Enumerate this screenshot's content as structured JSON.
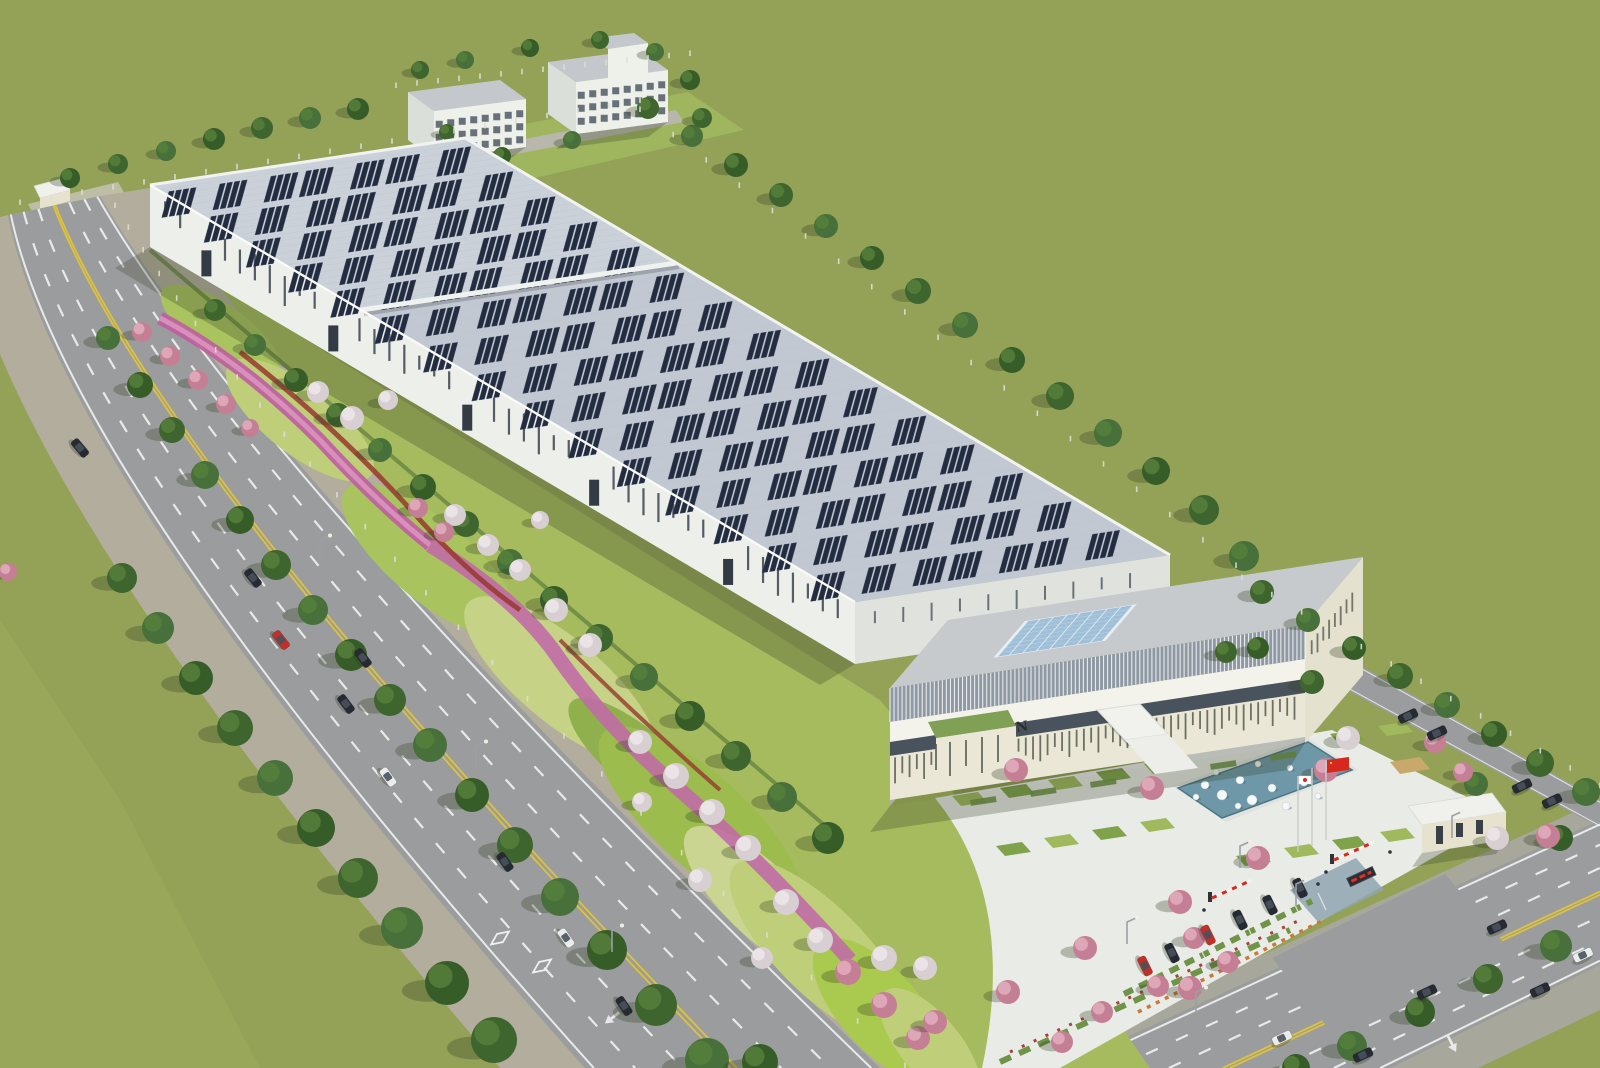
{
  "scene": {
    "sign": "CITIZEN",
    "flags": [
      {
        "name": "china-flag",
        "color": "#D7281E",
        "star": "#F8D33A"
      },
      {
        "name": "japan-flag",
        "color": "#FFFFFF",
        "dot": "#D7281E"
      }
    ],
    "colors": {
      "field": "#93A257",
      "fieldLight": "#9EAC5F",
      "road": "#9B9C9E",
      "sidewalk": "#B3AD9D",
      "sidewalk2": "#A8A79B",
      "laneYellow": "#E4C52F",
      "laneWhite": "#EFF1F1",
      "beltBase": "#A6BA5E",
      "beltL1": "#BFCE79",
      "beltL2": "#9CBC4D",
      "beltL3": "#C6D286",
      "beltL4": "#8FB04C",
      "ribbonMagenta": "#BE5E9E",
      "ribbonPink": "#D98FBC",
      "ribbonRed": "#96382E",
      "hedgeDark": "#5E7F3C",
      "treeGreen": "#3F652F",
      "treeGreen2": "#47703A",
      "treeGreen3": "#365C28",
      "treeLight": "#567F3B",
      "blossomWhite": "#D8CFD3",
      "blossomWhiteHi": "#EDE7E9",
      "blossomPink": "#C57F95",
      "blossomPinkHi": "#E0AEBE",
      "roofA": "#CBD1D9",
      "roofB": "#C2C8D2",
      "corr": "#B7BECA",
      "panel": "#242C40",
      "panelEdge": "#3A4560",
      "wall": "#EDEFEA",
      "wallShade": "#E0E3DD",
      "slit": "#39424C",
      "door": "#333B44",
      "parapet": "#F2F3F1",
      "officeRoof": "#C6CACD",
      "skylight": "#9FC0D8",
      "skyGrid": "#DCE8EE",
      "louverBg": "#8F99A3",
      "louverLine": "#FFFFFF",
      "bandWhite": "#F3F3EC",
      "glassBand": "#49535D",
      "cream": "#EAE7D6",
      "creamShade": "#DDD9C6",
      "creamDark": "#E4E1CF",
      "offSlit": "#565B4E",
      "signText": "#2A2E33",
      "wingGreen": "#7FA055",
      "pavement": "#E9EBE7",
      "grassSq": "#9FB95C",
      "grassSqDark": "#7FA24A",
      "tanSq": "#C8A96B",
      "pondRim": "#DFE3DE",
      "pond": "#6E98A8",
      "pondEdge": "#4E7585",
      "sphere": "#F4F8F8",
      "hedge": "#6F9347",
      "stallOrange": "#C8793C",
      "gatehouseRoof": "#F0F1ED",
      "gatehouseWall": "#E6E2CE",
      "ledBg": "#2A2D33",
      "ledRed": "#E03020",
      "apronBlue": "#8FA6B2",
      "concretePad": "#C6C3B4",
      "flagRed": "#D7281E",
      "flagDotYellow": "#F8D33A",
      "carBlack": "#262B33",
      "carRed": "#C23027",
      "carWhite": "#E9EDEC",
      "carGlass": "#49525C",
      "post": "#DEDED8",
      "lampPole": "#9AA0A6",
      "shadow": "rgba(50,62,32,0.30)",
      "bldgShadow": "rgba(55,65,40,0.28)",
      "dormRoof": "#C4C8CD",
      "dormWall": "#EEF0EA",
      "dormSide": "#DBDFDA",
      "dormWin": "#46515C",
      "dormPad": "#9FB55E",
      "dormPath": "#B9B7AC"
    },
    "roads": {
      "left": {
        "a": [
          8,
          215,
          60,
          480,
          585,
          1068
        ],
        "b": [
          100,
          196,
          260,
          470,
          880,
          1068
        ]
      },
      "bottom": {
        "a": [
          1060,
          1068,
          1600,
          820
        ],
        "b": [
          1390,
          1068,
          1600,
          965
        ]
      },
      "service": {
        "a": [
          1240,
          598,
          1600,
          800
        ],
        "b": [
          1226,
          624,
          1600,
          828
        ]
      }
    },
    "panels": {
      "hallA": {
        "matrix": [
          3.15,
          -0.47,
          2.11,
          1.25,
          150,
          185
        ],
        "cols": 7,
        "rows": 5,
        "s0": 4,
        "t0": 6,
        "ds": 14.2,
        "dt": 20
      },
      "hallB": {
        "matrix": [
          3.15,
          -0.47,
          4.94,
          2.92,
          361,
          310
        ],
        "cols": 7,
        "rows": 10,
        "s0": 4,
        "t0": 3,
        "ds": 14.2,
        "dt": 9.8
      }
    },
    "trees_back": [
      [
        648,
        108,
        11
      ],
      [
        692,
        136,
        11
      ],
      [
        736,
        165,
        12
      ],
      [
        781,
        195,
        12
      ],
      [
        826,
        226,
        12
      ],
      [
        872,
        258,
        12
      ],
      [
        918,
        291,
        13
      ],
      [
        965,
        325,
        13
      ],
      [
        1012,
        360,
        13
      ],
      [
        1060,
        396,
        14
      ],
      [
        1108,
        433,
        14
      ],
      [
        1156,
        471,
        14
      ],
      [
        1204,
        510,
        15
      ],
      [
        1244,
        556,
        15
      ],
      [
        70,
        178,
        10
      ],
      [
        118,
        164,
        10
      ],
      [
        166,
        151,
        10
      ],
      [
        214,
        139,
        11
      ],
      [
        262,
        128,
        11
      ],
      [
        310,
        118,
        11
      ],
      [
        358,
        109,
        11
      ],
      [
        420,
        70,
        9
      ],
      [
        465,
        60,
        9
      ],
      [
        530,
        48,
        9
      ],
      [
        600,
        40,
        9
      ],
      [
        655,
        52,
        9
      ],
      [
        690,
        80,
        10
      ],
      [
        702,
        118,
        10
      ],
      [
        572,
        140,
        9
      ],
      [
        502,
        156,
        9
      ],
      [
        447,
        132,
        8
      ]
    ],
    "trees": {
      "green": [
        [
          122,
          578,
          15
        ],
        [
          158,
          628,
          16
        ],
        [
          196,
          678,
          17
        ],
        [
          235,
          728,
          18
        ],
        [
          275,
          778,
          18
        ],
        [
          316,
          828,
          19
        ],
        [
          358,
          878,
          20
        ],
        [
          402,
          928,
          21
        ],
        [
          447,
          983,
          22
        ],
        [
          494,
          1040,
          23
        ],
        [
          108,
          338,
          12
        ],
        [
          140,
          385,
          13
        ],
        [
          172,
          430,
          13
        ],
        [
          205,
          475,
          14
        ],
        [
          240,
          520,
          14
        ],
        [
          276,
          565,
          15
        ],
        [
          313,
          610,
          15
        ],
        [
          351,
          655,
          16
        ],
        [
          390,
          700,
          16
        ],
        [
          430,
          745,
          17
        ],
        [
          472,
          795,
          17
        ],
        [
          515,
          845,
          18
        ],
        [
          560,
          897,
          19
        ],
        [
          607,
          950,
          20
        ],
        [
          656,
          1005,
          21
        ],
        [
          707,
          1060,
          22
        ],
        [
          760,
          1062,
          18
        ],
        [
          215,
          310,
          11
        ],
        [
          255,
          345,
          11
        ],
        [
          296,
          380,
          12
        ],
        [
          338,
          415,
          12
        ],
        [
          380,
          450,
          12
        ],
        [
          423,
          487,
          13
        ],
        [
          466,
          524,
          13
        ],
        [
          510,
          562,
          13
        ],
        [
          554,
          600,
          14
        ],
        [
          599,
          638,
          14
        ],
        [
          644,
          677,
          14
        ],
        [
          690,
          716,
          15
        ],
        [
          736,
          756,
          15
        ],
        [
          782,
          797,
          15
        ],
        [
          828,
          838,
          16
        ],
        [
          1262,
          592,
          12
        ],
        [
          1308,
          620,
          12
        ],
        [
          1354,
          648,
          12
        ],
        [
          1400,
          676,
          13
        ],
        [
          1447,
          705,
          13
        ],
        [
          1494,
          734,
          13
        ],
        [
          1540,
          763,
          14
        ],
        [
          1586,
          792,
          14
        ],
        [
          1258,
          648,
          11
        ],
        [
          1312,
          682,
          12
        ],
        [
          1476,
          784,
          12
        ],
        [
          1560,
          838,
          13
        ],
        [
          1226,
          652,
          11
        ],
        [
          1352,
          1046,
          15
        ],
        [
          1420,
          1012,
          15
        ],
        [
          1488,
          979,
          15
        ],
        [
          1556,
          946,
          16
        ],
        [
          1296,
          1068,
          14
        ]
      ],
      "white": [
        [
          318,
          392,
          11
        ],
        [
          352,
          418,
          12
        ],
        [
          388,
          400,
          10
        ],
        [
          455,
          515,
          11
        ],
        [
          488,
          545,
          11
        ],
        [
          520,
          570,
          11
        ],
        [
          556,
          610,
          12
        ],
        [
          590,
          645,
          12
        ],
        [
          540,
          520,
          9
        ],
        [
          640,
          742,
          12
        ],
        [
          676,
          776,
          13
        ],
        [
          712,
          812,
          13
        ],
        [
          748,
          848,
          13
        ],
        [
          700,
          880,
          12
        ],
        [
          642,
          802,
          10
        ],
        [
          786,
          902,
          13
        ],
        [
          820,
          940,
          13
        ],
        [
          762,
          958,
          11
        ],
        [
          884,
          958,
          13
        ],
        [
          925,
          968,
          12
        ],
        [
          1348,
          738,
          12
        ],
        [
          1497,
          838,
          12
        ]
      ],
      "pink": [
        [
          142,
          332,
          10
        ],
        [
          170,
          356,
          10
        ],
        [
          198,
          380,
          10
        ],
        [
          226,
          404,
          10
        ],
        [
          418,
          508,
          10
        ],
        [
          444,
          532,
          10
        ],
        [
          848,
          972,
          13
        ],
        [
          884,
          1005,
          13
        ],
        [
          918,
          1038,
          12
        ],
        [
          8,
          572,
          9
        ],
        [
          250,
          428,
          9
        ],
        [
          1016,
          770,
          12
        ],
        [
          1152,
          788,
          12
        ],
        [
          1326,
          770,
          12
        ],
        [
          1258,
          858,
          12
        ],
        [
          1180,
          902,
          12
        ],
        [
          1085,
          948,
          12
        ],
        [
          1008,
          992,
          12
        ],
        [
          935,
          1022,
          12
        ],
        [
          1548,
          836,
          12
        ],
        [
          1435,
          742,
          11
        ],
        [
          1190,
          988,
          12
        ],
        [
          1194,
          938,
          11
        ],
        [
          1228,
          962,
          11
        ],
        [
          1158,
          986,
          11
        ],
        [
          1102,
          1012,
          11
        ],
        [
          1062,
          1042,
          11
        ],
        [
          1463,
          772,
          10
        ]
      ]
    },
    "cars": {
      "moving": [
        [
          80,
          448,
          50,
          "black"
        ],
        [
          253,
          578,
          52,
          "black"
        ],
        [
          281,
          640,
          52,
          "red"
        ],
        [
          363,
          658,
          53,
          "black"
        ],
        [
          346,
          704,
          53,
          "black"
        ],
        [
          388,
          777,
          54,
          "white"
        ],
        [
          505,
          862,
          55,
          "black"
        ],
        [
          566,
          938,
          55,
          "white"
        ],
        [
          624,
          1006,
          56,
          "black"
        ],
        [
          1497,
          927,
          -25,
          "black"
        ],
        [
          1427,
          992,
          -25,
          "black"
        ],
        [
          1363,
          1055,
          -25,
          "black"
        ],
        [
          1282,
          1038,
          -25,
          "white"
        ],
        [
          1583,
          955,
          -25,
          "white"
        ],
        [
          1540,
          990,
          -25,
          "black"
        ]
      ],
      "parked": [
        [
          1145,
          966,
          64,
          "red"
        ],
        [
          1172,
          953,
          64,
          "black"
        ],
        [
          1208,
          935,
          64,
          "red"
        ],
        [
          1240,
          920,
          64,
          "black"
        ],
        [
          1270,
          905,
          64,
          "black"
        ],
        [
          1300,
          888,
          64,
          "black"
        ],
        [
          1408,
          716,
          -25,
          "black"
        ],
        [
          1437,
          733,
          -25,
          "black"
        ],
        [
          1522,
          786,
          -25,
          "black"
        ],
        [
          1552,
          801,
          -25,
          "black"
        ]
      ]
    },
    "spheres": [
      [
        1205,
        785,
        4
      ],
      [
        1222,
        795,
        5
      ],
      [
        1216,
        772,
        3
      ],
      [
        1240,
        780,
        4
      ],
      [
        1252,
        800,
        5
      ],
      [
        1258,
        764,
        3
      ],
      [
        1272,
        788,
        4
      ],
      [
        1286,
        806,
        4
      ],
      [
        1290,
        768,
        3
      ],
      [
        1304,
        782,
        4
      ],
      [
        1318,
        796,
        3
      ],
      [
        1326,
        776,
        3
      ],
      [
        1238,
        806,
        3
      ],
      [
        1196,
        797,
        3
      ]
    ],
    "squares": {
      "green": [
        [
          952,
          796
        ],
        [
          1000,
          788
        ],
        [
          1048,
          780
        ],
        [
          1096,
          772
        ],
        [
          1144,
          764
        ],
        [
          996,
          846
        ],
        [
          1044,
          838
        ],
        [
          1092,
          830
        ],
        [
          1140,
          822
        ],
        [
          1330,
          734
        ],
        [
          1378,
          726
        ],
        [
          1236,
          856
        ],
        [
          1284,
          848
        ],
        [
          1332,
          840
        ],
        [
          1380,
          832
        ]
      ],
      "tan": [
        [
          1294,
          756
        ],
        [
          1390,
          762
        ]
      ]
    },
    "planters": [
      [
        970,
        800
      ],
      [
        1030,
        791
      ],
      [
        1090,
        782
      ],
      [
        1210,
        764
      ],
      [
        1270,
        755
      ]
    ],
    "stalls": {
      "a": [
        1132,
        986
      ],
      "b": [
        1318,
        893
      ],
      "n": 9
    },
    "fences": [
      {
        "t": "q",
        "p": [
          115,
          208,
          280,
          486,
          905,
          1068
        ],
        "n": 26
      },
      {
        "t": "l",
        "p": [
          20,
          205,
          640,
          103
        ],
        "n": 20
      },
      {
        "t": "l",
        "p": [
          640,
          112,
          1236,
          568
        ],
        "n": 18
      },
      {
        "t": "l",
        "p": [
          1242,
          580,
          1600,
          788
        ],
        "n": 12
      },
      {
        "t": "l",
        "p": [
          396,
          88,
          690,
          56
        ],
        "n": 14
      }
    ],
    "lamps": [
      [
        320,
        562
      ],
      [
        476,
        768
      ],
      [
        612,
        952
      ],
      [
        1296,
        906
      ],
      [
        1452,
        838
      ],
      [
        1196,
        1014
      ],
      [
        1127,
        944
      ],
      [
        1240,
        868
      ]
    ],
    "marks": {
      "diamonds": [
        [
          500,
          938,
          54
        ],
        [
          542,
          966,
          54
        ],
        [
          1408,
          982,
          -25
        ]
      ],
      "arrows": [
        [
          612,
          1018,
          232
        ],
        [
          1452,
          1044,
          153
        ],
        [
          996,
          1056,
          335
        ]
      ]
    },
    "dorm": {
      "floors": 3,
      "cols": 8
    }
  }
}
